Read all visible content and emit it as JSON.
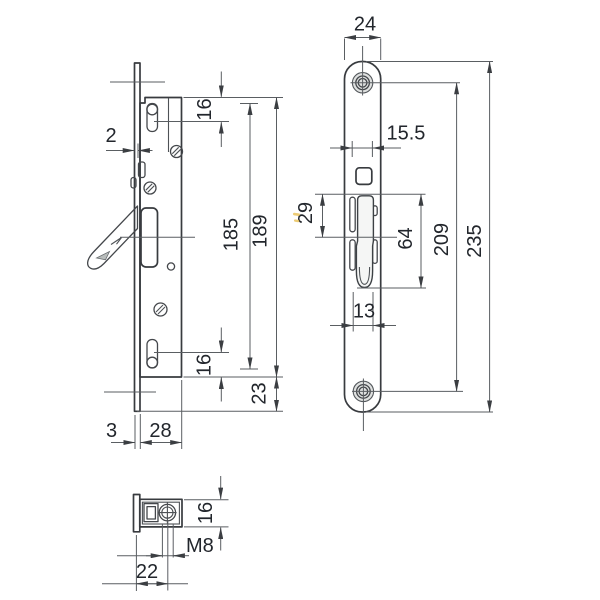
{
  "drawing": {
    "type": "technical-dimension-drawing",
    "subject": "mortise-gate-lock",
    "colors": {
      "background": "#ffffff",
      "part_fill": "#d3d6d5",
      "plate_fill": "#e2e4e3",
      "hole_fill": "#f5f6f5",
      "outline": "#383b3f",
      "dimension_line": "#5a5e62",
      "text": "#22262c",
      "artifact_yellow": "#e9c054"
    },
    "views": {
      "side": {
        "dims": {
          "latch_protrusion": "2",
          "pin_top_offset": "16",
          "inner_height": "185",
          "case_height": "189",
          "pin_bottom_offset": "16",
          "plate_overhang": "23",
          "plate_thickness": "3",
          "case_depth": "28"
        }
      },
      "front": {
        "dims": {
          "plate_width": "24",
          "follower_offset": "15.5",
          "notch_pitch": "29",
          "slot_length": "64",
          "hole_pitch": "209",
          "plate_length": "235",
          "slot_width": "13"
        }
      },
      "section": {
        "dims": {
          "case_width": "16",
          "thread": "M8",
          "axis_offset": "22"
        }
      }
    }
  }
}
